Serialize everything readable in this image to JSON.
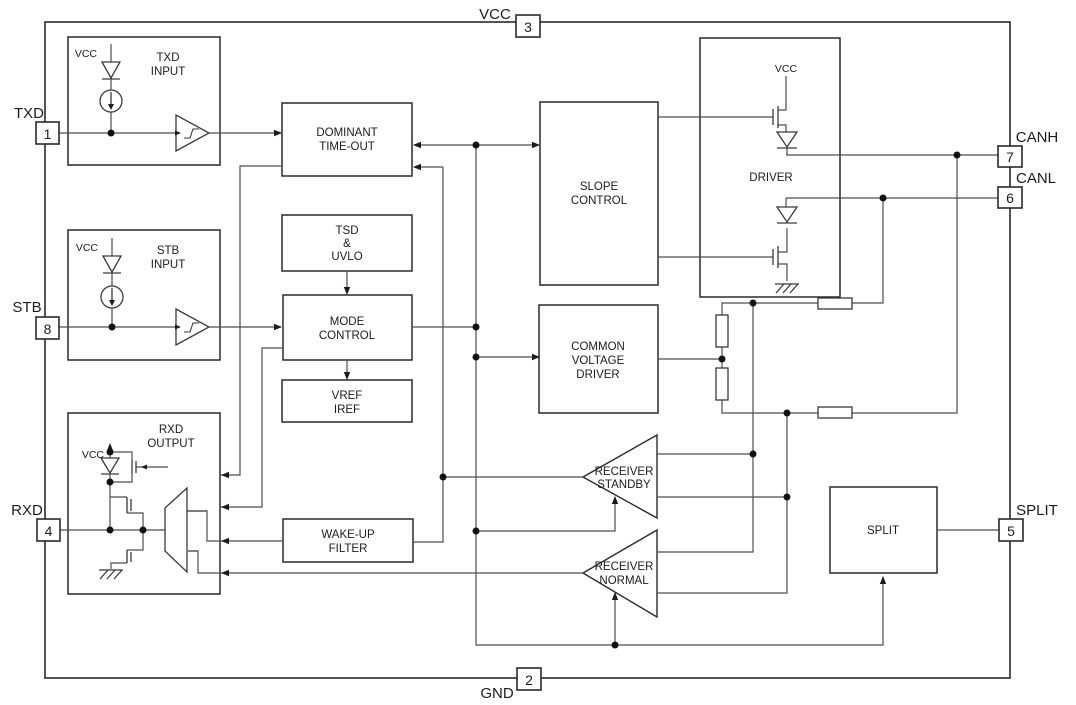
{
  "diagram": {
    "background": "#ffffff",
    "wire_color": "#4d4d4d",
    "box_border_color": "#2a2a2a",
    "text_color": "#1c1c1c"
  },
  "pins": {
    "txd": {
      "label": "TXD",
      "number": "1"
    },
    "stb": {
      "label": "STB",
      "number": "8"
    },
    "rxd": {
      "label": "RXD",
      "number": "4"
    },
    "vcc": {
      "label": "VCC",
      "number": "3"
    },
    "gnd": {
      "label": "GND",
      "number": "2"
    },
    "canh": {
      "label": "CANH",
      "number": "7"
    },
    "canl": {
      "label": "CANL",
      "number": "6"
    },
    "split": {
      "label": "SPLIT",
      "number": "5"
    }
  },
  "blocks": {
    "txd_input": {
      "line1": "TXD",
      "line2": "INPUT",
      "vcc_label": "VCC"
    },
    "stb_input": {
      "line1": "STB",
      "line2": "INPUT",
      "vcc_label": "VCC"
    },
    "rxd_output": {
      "line1": "RXD",
      "line2": "OUTPUT",
      "vcc_label": "VCC"
    },
    "dominant_timeout": {
      "line1": "DOMINANT",
      "line2": "TIME-OUT"
    },
    "tsd_uvlo": {
      "line1": "TSD",
      "line2": "&",
      "line3": "UVLO"
    },
    "mode_control": {
      "line1": "MODE",
      "line2": "CONTROL"
    },
    "vref_iref": {
      "line1": "VREF",
      "line2": "IREF"
    },
    "wakeup_filter": {
      "line1": "WAKE-UP",
      "line2": "FILTER"
    },
    "slope_control": {
      "line1": "SLOPE",
      "line2": "CONTROL"
    },
    "common_voltage_driver": {
      "line1": "COMMON",
      "line2": "VOLTAGE",
      "line3": "DRIVER"
    },
    "driver": {
      "label": "DRIVER",
      "vcc_label": "VCC"
    },
    "split_block": {
      "label": "SPLIT"
    },
    "receiver_standby": {
      "line1": "RECEIVER",
      "line2": "STANDBY"
    },
    "receiver_normal": {
      "line1": "RECEIVER",
      "line2": "NORMAL"
    }
  }
}
